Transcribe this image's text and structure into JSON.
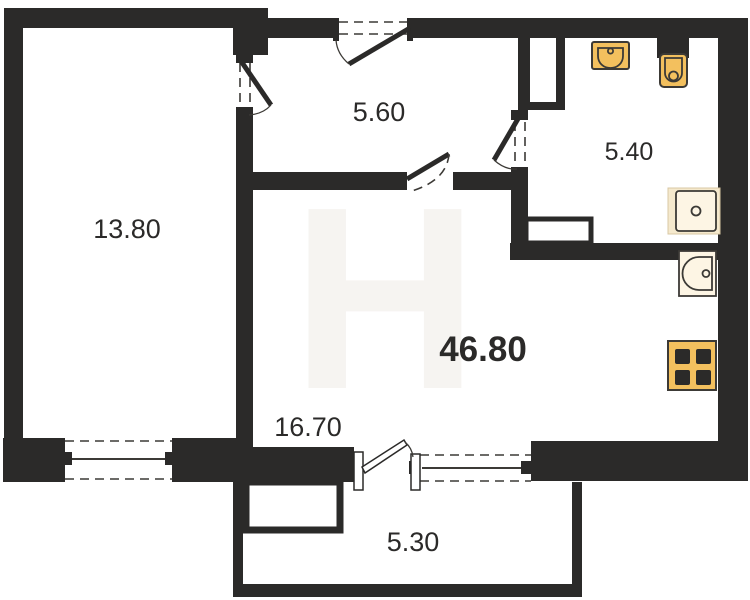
{
  "plan": {
    "title": "apartment-floor-plan",
    "watermark_glyph": "Н",
    "rooms": [
      {
        "name": "bedroom",
        "area": "13.80"
      },
      {
        "name": "hallway",
        "area": "5.60"
      },
      {
        "name": "bathroom",
        "area": "5.40"
      },
      {
        "name": "living-kitchen",
        "area": "46.80"
      },
      {
        "name": "kitchen-zone",
        "area": "16.70"
      },
      {
        "name": "balcony",
        "area": "5.30"
      }
    ],
    "fixtures": [
      {
        "name": "bath-sink"
      },
      {
        "name": "toilet"
      },
      {
        "name": "washing-machine"
      },
      {
        "name": "kitchen-sink"
      },
      {
        "name": "stove"
      }
    ],
    "colors": {
      "wall": "#2b2a29",
      "line": "#3c3a36",
      "orange": "#f3c05e",
      "cream": "#fdf5e4",
      "tan": "#f5e9cd",
      "paper": "#ffffff",
      "watermark": "#f6f4f1",
      "text": "#2b2a29"
    }
  }
}
